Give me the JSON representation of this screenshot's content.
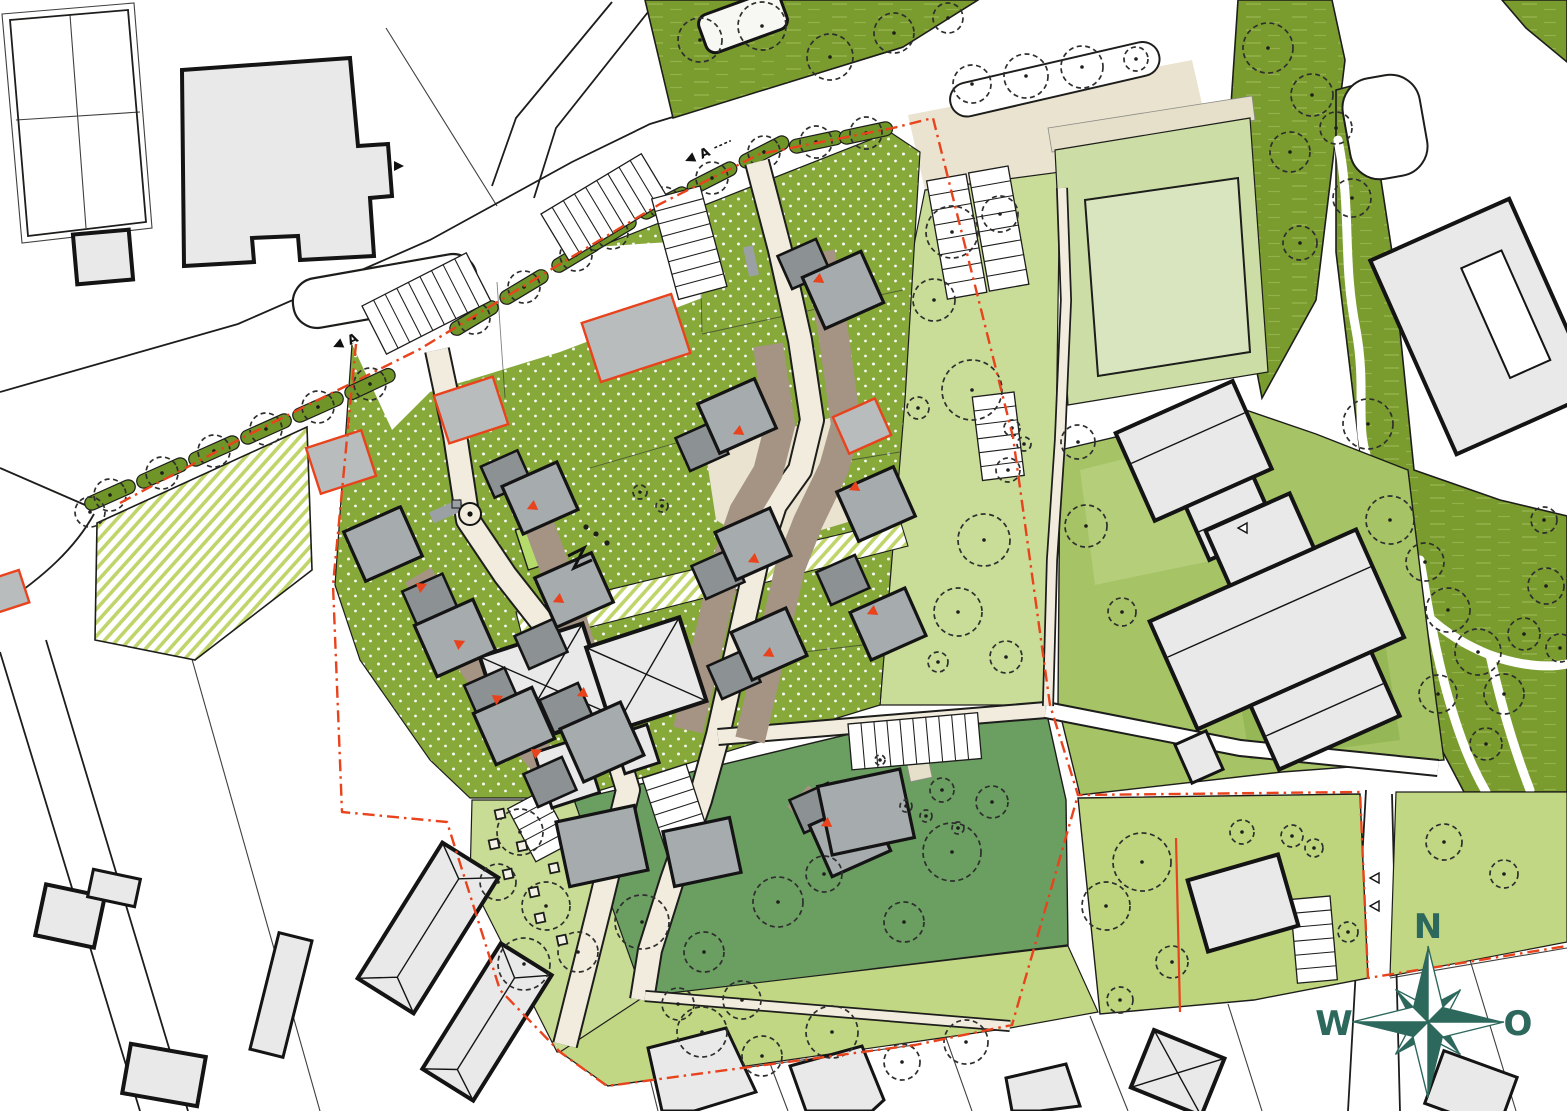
{
  "compass": {
    "north": "N",
    "west": "W",
    "east": "O",
    "south": "S"
  },
  "section_marker": {
    "label": "A"
  },
  "colors": {
    "paper": "#ffffff",
    "line": "#1d1d1b",
    "bexist": "#e9e9e9",
    "bnew": "#a6abad",
    "garage": "#8c9194",
    "plot": "#b9bcbc",
    "road": "#f1ecdd",
    "plaza": "#e9e3d0",
    "beige": "#e6dfc9",
    "drive": "#a59483",
    "gdark": "#7a9c2e",
    "gverge": "#6f9428",
    "glawn": "#86a93a",
    "gsage": "#6b9e61",
    "glight": "#c2d784",
    "gopen": "#c9dc98",
    "gplay": "#c9dc96",
    "gschool": "#a6c365",
    "gsports": "#ccdea6",
    "gfield": "#d9e5bf",
    "gbr": "#bed57e",
    "stripe": "#bfd56a",
    "red": "#e8431c",
    "teal": "#2c685c"
  },
  "map": {
    "trees": [
      [
        700,
        40,
        22
      ],
      [
        762,
        26,
        24
      ],
      [
        830,
        57,
        23
      ],
      [
        894,
        33,
        20
      ],
      [
        948,
        18,
        15
      ],
      [
        972,
        84,
        19
      ],
      [
        1026,
        76,
        22
      ],
      [
        1082,
        67,
        21
      ],
      [
        1136,
        59,
        12
      ],
      [
        1268,
        48,
        25
      ],
      [
        1312,
        95,
        21
      ],
      [
        1290,
        152,
        20
      ],
      [
        1336,
        128,
        16
      ],
      [
        1352,
        198,
        19
      ],
      [
        1300,
        243,
        17
      ],
      [
        1368,
        424,
        25
      ],
      [
        1390,
        520,
        24
      ],
      [
        1425,
        562,
        19
      ],
      [
        1448,
        610,
        22
      ],
      [
        1478,
        652,
        23
      ],
      [
        1438,
        694,
        19
      ],
      [
        1504,
        694,
        20
      ],
      [
        1524,
        634,
        16
      ],
      [
        1546,
        586,
        18
      ],
      [
        1486,
        744,
        16
      ],
      [
        1544,
        520,
        13
      ],
      [
        1560,
        648,
        14
      ],
      [
        952,
        232,
        26
      ],
      [
        1000,
        214,
        18
      ],
      [
        934,
        300,
        21
      ],
      [
        972,
        390,
        30
      ],
      [
        1008,
        470,
        12
      ],
      [
        984,
        540,
        26
      ],
      [
        958,
        612,
        24
      ],
      [
        1006,
        657,
        16
      ],
      [
        938,
        662,
        10
      ],
      [
        918,
        408,
        11
      ],
      [
        1012,
        428,
        8
      ],
      [
        1024,
        444,
        7
      ],
      [
        1086,
        526,
        21
      ],
      [
        1122,
        612,
        14
      ],
      [
        1078,
        442,
        17
      ],
      [
        640,
        492,
        7
      ],
      [
        662,
        506,
        6
      ],
      [
        90,
        512,
        15
      ],
      [
        642,
        922,
        27
      ],
      [
        704,
        952,
        20
      ],
      [
        778,
        902,
        25
      ],
      [
        824,
        874,
        18
      ],
      [
        952,
        852,
        29
      ],
      [
        904,
        922,
        20
      ],
      [
        992,
        802,
        16
      ],
      [
        942,
        790,
        12
      ],
      [
        926,
        816,
        6
      ],
      [
        958,
        828,
        6
      ],
      [
        906,
        806,
        6
      ],
      [
        880,
        760,
        5
      ],
      [
        520,
        832,
        23
      ],
      [
        498,
        882,
        18
      ],
      [
        546,
        906,
        24
      ],
      [
        578,
        952,
        20
      ],
      [
        524,
        964,
        26
      ],
      [
        702,
        1032,
        25
      ],
      [
        762,
        1056,
        20
      ],
      [
        832,
        1032,
        26
      ],
      [
        902,
        1062,
        18
      ],
      [
        966,
        1042,
        22
      ],
      [
        678,
        1004,
        16
      ],
      [
        742,
        1000,
        19
      ],
      [
        1142,
        862,
        29
      ],
      [
        1106,
        906,
        24
      ],
      [
        1242,
        832,
        12
      ],
      [
        1292,
        836,
        11
      ],
      [
        1314,
        848,
        9
      ],
      [
        1172,
        962,
        16
      ],
      [
        1348,
        932,
        10
      ],
      [
        1120,
        1000,
        13
      ],
      [
        1444,
        842,
        18
      ],
      [
        1504,
        874,
        14
      ]
    ],
    "street_trees": [
      [
        110,
        495,
        -24
      ],
      [
        162,
        473,
        -24
      ],
      [
        214,
        451,
        -24
      ],
      [
        266,
        429,
        -24
      ],
      [
        318,
        407,
        -24
      ],
      [
        370,
        384,
        -25
      ],
      [
        474,
        318,
        -31
      ],
      [
        524,
        287,
        -31
      ],
      [
        576,
        255,
        -31
      ],
      [
        612,
        233,
        -31
      ],
      [
        664,
        203,
        -27
      ],
      [
        712,
        178,
        -27
      ],
      [
        764,
        152,
        -27
      ],
      [
        816,
        142,
        -12
      ],
      [
        866,
        133,
        -12
      ]
    ],
    "parking_rows": [
      [
        362,
        306,
        -27,
        9,
        13,
        54
      ],
      [
        541,
        214,
        -31,
        9,
        13,
        54
      ],
      [
        700,
        186,
        75,
        8,
        13,
        50
      ],
      [
        966,
        174,
        80,
        8,
        15,
        40
      ],
      [
        1008,
        166,
        80,
        8,
        15,
        40
      ],
      [
        1014,
        392,
        83,
        6,
        14,
        42
      ],
      [
        686,
        764,
        72,
        7,
        13,
        46
      ],
      [
        848,
        724,
        -5,
        10,
        13,
        46
      ],
      [
        543,
        790,
        62,
        5,
        12,
        40
      ],
      [
        1330,
        896,
        85,
        6,
        14,
        40
      ]
    ],
    "houses": [
      [
        383,
        544,
        62,
        54,
        -24,
        "h"
      ],
      [
        430,
        600,
        44,
        38,
        -24,
        "g"
      ],
      [
        455,
        638,
        64,
        56,
        -24,
        "h"
      ],
      [
        492,
        694,
        44,
        38,
        -24,
        "g"
      ],
      [
        514,
        726,
        64,
        56,
        -24,
        "h"
      ],
      [
        550,
        782,
        42,
        36,
        -24,
        "g"
      ],
      [
        506,
        474,
        40,
        34,
        -24,
        "g"
      ],
      [
        540,
        498,
        60,
        52,
        -24,
        "h"
      ],
      [
        541,
        644,
        42,
        36,
        -24,
        "g"
      ],
      [
        574,
        590,
        62,
        54,
        -24,
        "h"
      ],
      [
        566,
        708,
        42,
        36,
        -24,
        "g"
      ],
      [
        602,
        742,
        66,
        58,
        -24,
        "h"
      ],
      [
        702,
        446,
        42,
        36,
        -24,
        "g"
      ],
      [
        737,
        416,
        62,
        54,
        -24,
        "h"
      ],
      [
        718,
        574,
        42,
        36,
        -24,
        "g"
      ],
      [
        753,
        544,
        60,
        52,
        -24,
        "h"
      ],
      [
        734,
        674,
        42,
        36,
        -24,
        "g"
      ],
      [
        769,
        644,
        60,
        52,
        -24,
        "h"
      ],
      [
        804,
        264,
        42,
        36,
        -24,
        "g"
      ],
      [
        843,
        290,
        64,
        56,
        -24,
        "h"
      ],
      [
        862,
        426,
        46,
        40,
        -24,
        "p"
      ],
      [
        876,
        504,
        62,
        54,
        -24,
        "h"
      ],
      [
        843,
        580,
        42,
        36,
        -24,
        "g"
      ],
      [
        888,
        624,
        60,
        52,
        -24,
        "h"
      ],
      [
        816,
        808,
        42,
        36,
        -24,
        "g"
      ],
      [
        850,
        838,
        64,
        56,
        -24,
        "h"
      ],
      [
        636,
        338,
        94,
        62,
        -18,
        "p"
      ],
      [
        471,
        410,
        62,
        50,
        -18,
        "p"
      ],
      [
        341,
        462,
        58,
        48,
        -18,
        "p"
      ],
      [
        6,
        592,
        38,
        34,
        -18,
        "p"
      ],
      [
        602,
        846,
        80,
        66,
        -12,
        "k"
      ],
      [
        702,
        852,
        68,
        56,
        -12,
        "k"
      ],
      [
        866,
        812,
        84,
        70,
        -12,
        "k"
      ],
      [
        1243,
        903,
        94,
        74,
        -16,
        "e"
      ]
    ],
    "red_arrows": [
      [
        418,
        588,
        -24
      ],
      [
        456,
        645,
        -24
      ],
      [
        494,
        700,
        -24
      ],
      [
        533,
        754,
        -24
      ],
      [
        536,
        505,
        156
      ],
      [
        562,
        598,
        156
      ],
      [
        586,
        692,
        156
      ],
      [
        742,
        430,
        156
      ],
      [
        757,
        558,
        156
      ],
      [
        772,
        652,
        156
      ],
      [
        822,
        278,
        156
      ],
      [
        858,
        486,
        156
      ],
      [
        876,
        610,
        156
      ],
      [
        830,
        822,
        156
      ],
      [
        751,
        262,
        65
      ]
    ],
    "play_squares": [
      [
        500,
        814
      ],
      [
        522,
        846
      ],
      [
        508,
        874
      ],
      [
        534,
        892
      ],
      [
        554,
        868
      ],
      [
        494,
        844
      ],
      [
        540,
        918
      ],
      [
        562,
        940
      ]
    ]
  }
}
